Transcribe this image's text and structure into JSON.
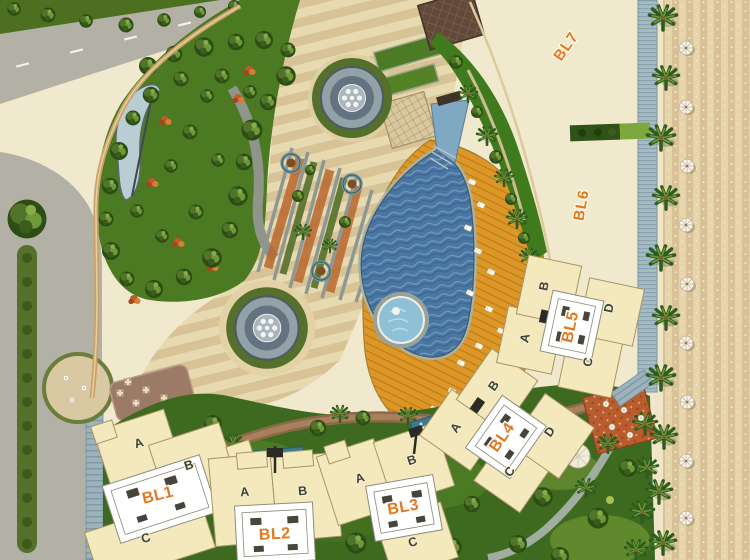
{
  "plan": {
    "type": "resort-site-plan",
    "blocks": [
      {
        "id": "BL1",
        "wings": [
          "A",
          "B",
          "C"
        ]
      },
      {
        "id": "BL2",
        "wings": [
          "A",
          "B"
        ]
      },
      {
        "id": "BL3",
        "wings": [
          "A",
          "B",
          "C"
        ]
      },
      {
        "id": "BL4",
        "wings": [
          "A",
          "B",
          "C",
          "D"
        ]
      },
      {
        "id": "BL5",
        "wings": [
          "A",
          "B",
          "C",
          "D"
        ]
      },
      {
        "id": "BL6",
        "wings": []
      },
      {
        "id": "BL7",
        "wings": []
      }
    ],
    "colors": {
      "block_label": "#e0791f",
      "wing_letter": "#3f4136",
      "pool_water": "#4a76a2",
      "deck_wood": "#dd9728",
      "lawn_green": "#4c7a22",
      "sand_beige": "#e6d4ab",
      "road_gray": "#b3b0a6",
      "building_cream": "#f3e9bd",
      "terracotta": "#b95c2e"
    }
  }
}
